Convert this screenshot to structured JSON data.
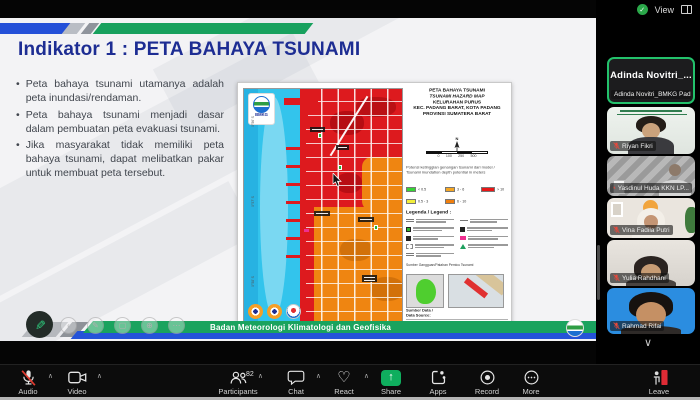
{
  "window": {
    "view_label": "View"
  },
  "icons": {
    "bullet": "•",
    "caret_up": "∧",
    "chevron_down": "∨",
    "heart": "♡",
    "check": "✓",
    "up_arrow": "↑",
    "pen": "✎",
    "ghost_left": "‹",
    "ghost_pen": "✎",
    "ghost_shape": "▢",
    "ghost_zoom": "⊕",
    "ghost_more": "⋯",
    "north": "N"
  },
  "slide": {
    "title": "Indikator 1 : PETA BAHAYA TSUNAMI",
    "bullets": [
      "Peta bahaya tsunami utamanya adalah peta inundasi/rendaman.",
      "Peta bahaya tsunami menjadi dasar dalam pembuatan peta evakuasi tsunami.",
      "Jika masyarakat tidak memiliki peta bahaya tsunami, dapat melibatkan pakar untuk membuat peta tersebut."
    ],
    "footer_banner": "Badan Meteorologi Klimatologi dan Geofisika"
  },
  "map_figure": {
    "logo_text": "BMKG",
    "title_lines": [
      "PETA BAHAYA TSUNAMI",
      "TSUNAMI HAZARD MAP",
      "KELURAHAN PURUS",
      "KEC. PADANG BARAT, KOTA PADANG",
      "PROVINSI SUMATERA BARAT"
    ],
    "scale_ticks": [
      "0",
      "100",
      "250",
      "500"
    ],
    "note_lines": [
      "Potensi ketinggian genangan tsunami dari model /",
      "Tsunami inundation depth potential in meters"
    ],
    "depth_classes": [
      {
        "color": "#35d435",
        "label": "< 0.5"
      },
      {
        "color": "#f2ee3a",
        "label": "0.5 - 3"
      },
      {
        "color": "#f5a623",
        "label": "3 - 6"
      },
      {
        "color": "#f07f0e",
        "label": "6 - 10"
      },
      {
        "color": "#e81717",
        "label": "> 10"
      }
    ],
    "legend_title": "Legenda / Legend :",
    "inset_caption": "Sumber Gangguan/Patahan Pemicu Tsunami",
    "source_heading_1": "Sumber Data /",
    "source_heading_2": "Data Source:",
    "coords": {
      "left": [
        "0°56' S",
        "0°57' S",
        "0°58' S"
      ],
      "bottom_left": "100°21' E",
      "bottom_right": "100°21.25' E"
    }
  },
  "sidebar": {
    "active_big_name": "Adinda  Novitri_...",
    "tiles": [
      {
        "name": "Adinda Novitri_BMKG Pad..."
      },
      {
        "name": "Riyan Fikri"
      },
      {
        "name": "Yasdinul Huda KKN LP..."
      },
      {
        "name": "Vina Fadila Putri"
      },
      {
        "name": "Yulia Rahdhani"
      },
      {
        "name": "Rahmad Rifai"
      }
    ]
  },
  "toolbar": {
    "items": [
      {
        "label": "Audio"
      },
      {
        "label": "Video"
      },
      {
        "label": "Participants",
        "badge": "82"
      },
      {
        "label": "Chat"
      },
      {
        "label": "React"
      },
      {
        "label": "Share"
      },
      {
        "label": "Apps"
      },
      {
        "label": "Record"
      },
      {
        "label": "More"
      },
      {
        "label": "Leave"
      }
    ]
  },
  "colors": {
    "accent_green": "#23c16b",
    "share_green": "#0fae5e",
    "leave_red": "#e02b35",
    "title_navy": "#1d2d93",
    "banner_green": "#1aa35e",
    "ribbon_blue": "#2450d8",
    "hazard_red": "#dd1a1e",
    "hazard_orange": "#ef8511",
    "sea_cyan": "#33c4ec"
  }
}
